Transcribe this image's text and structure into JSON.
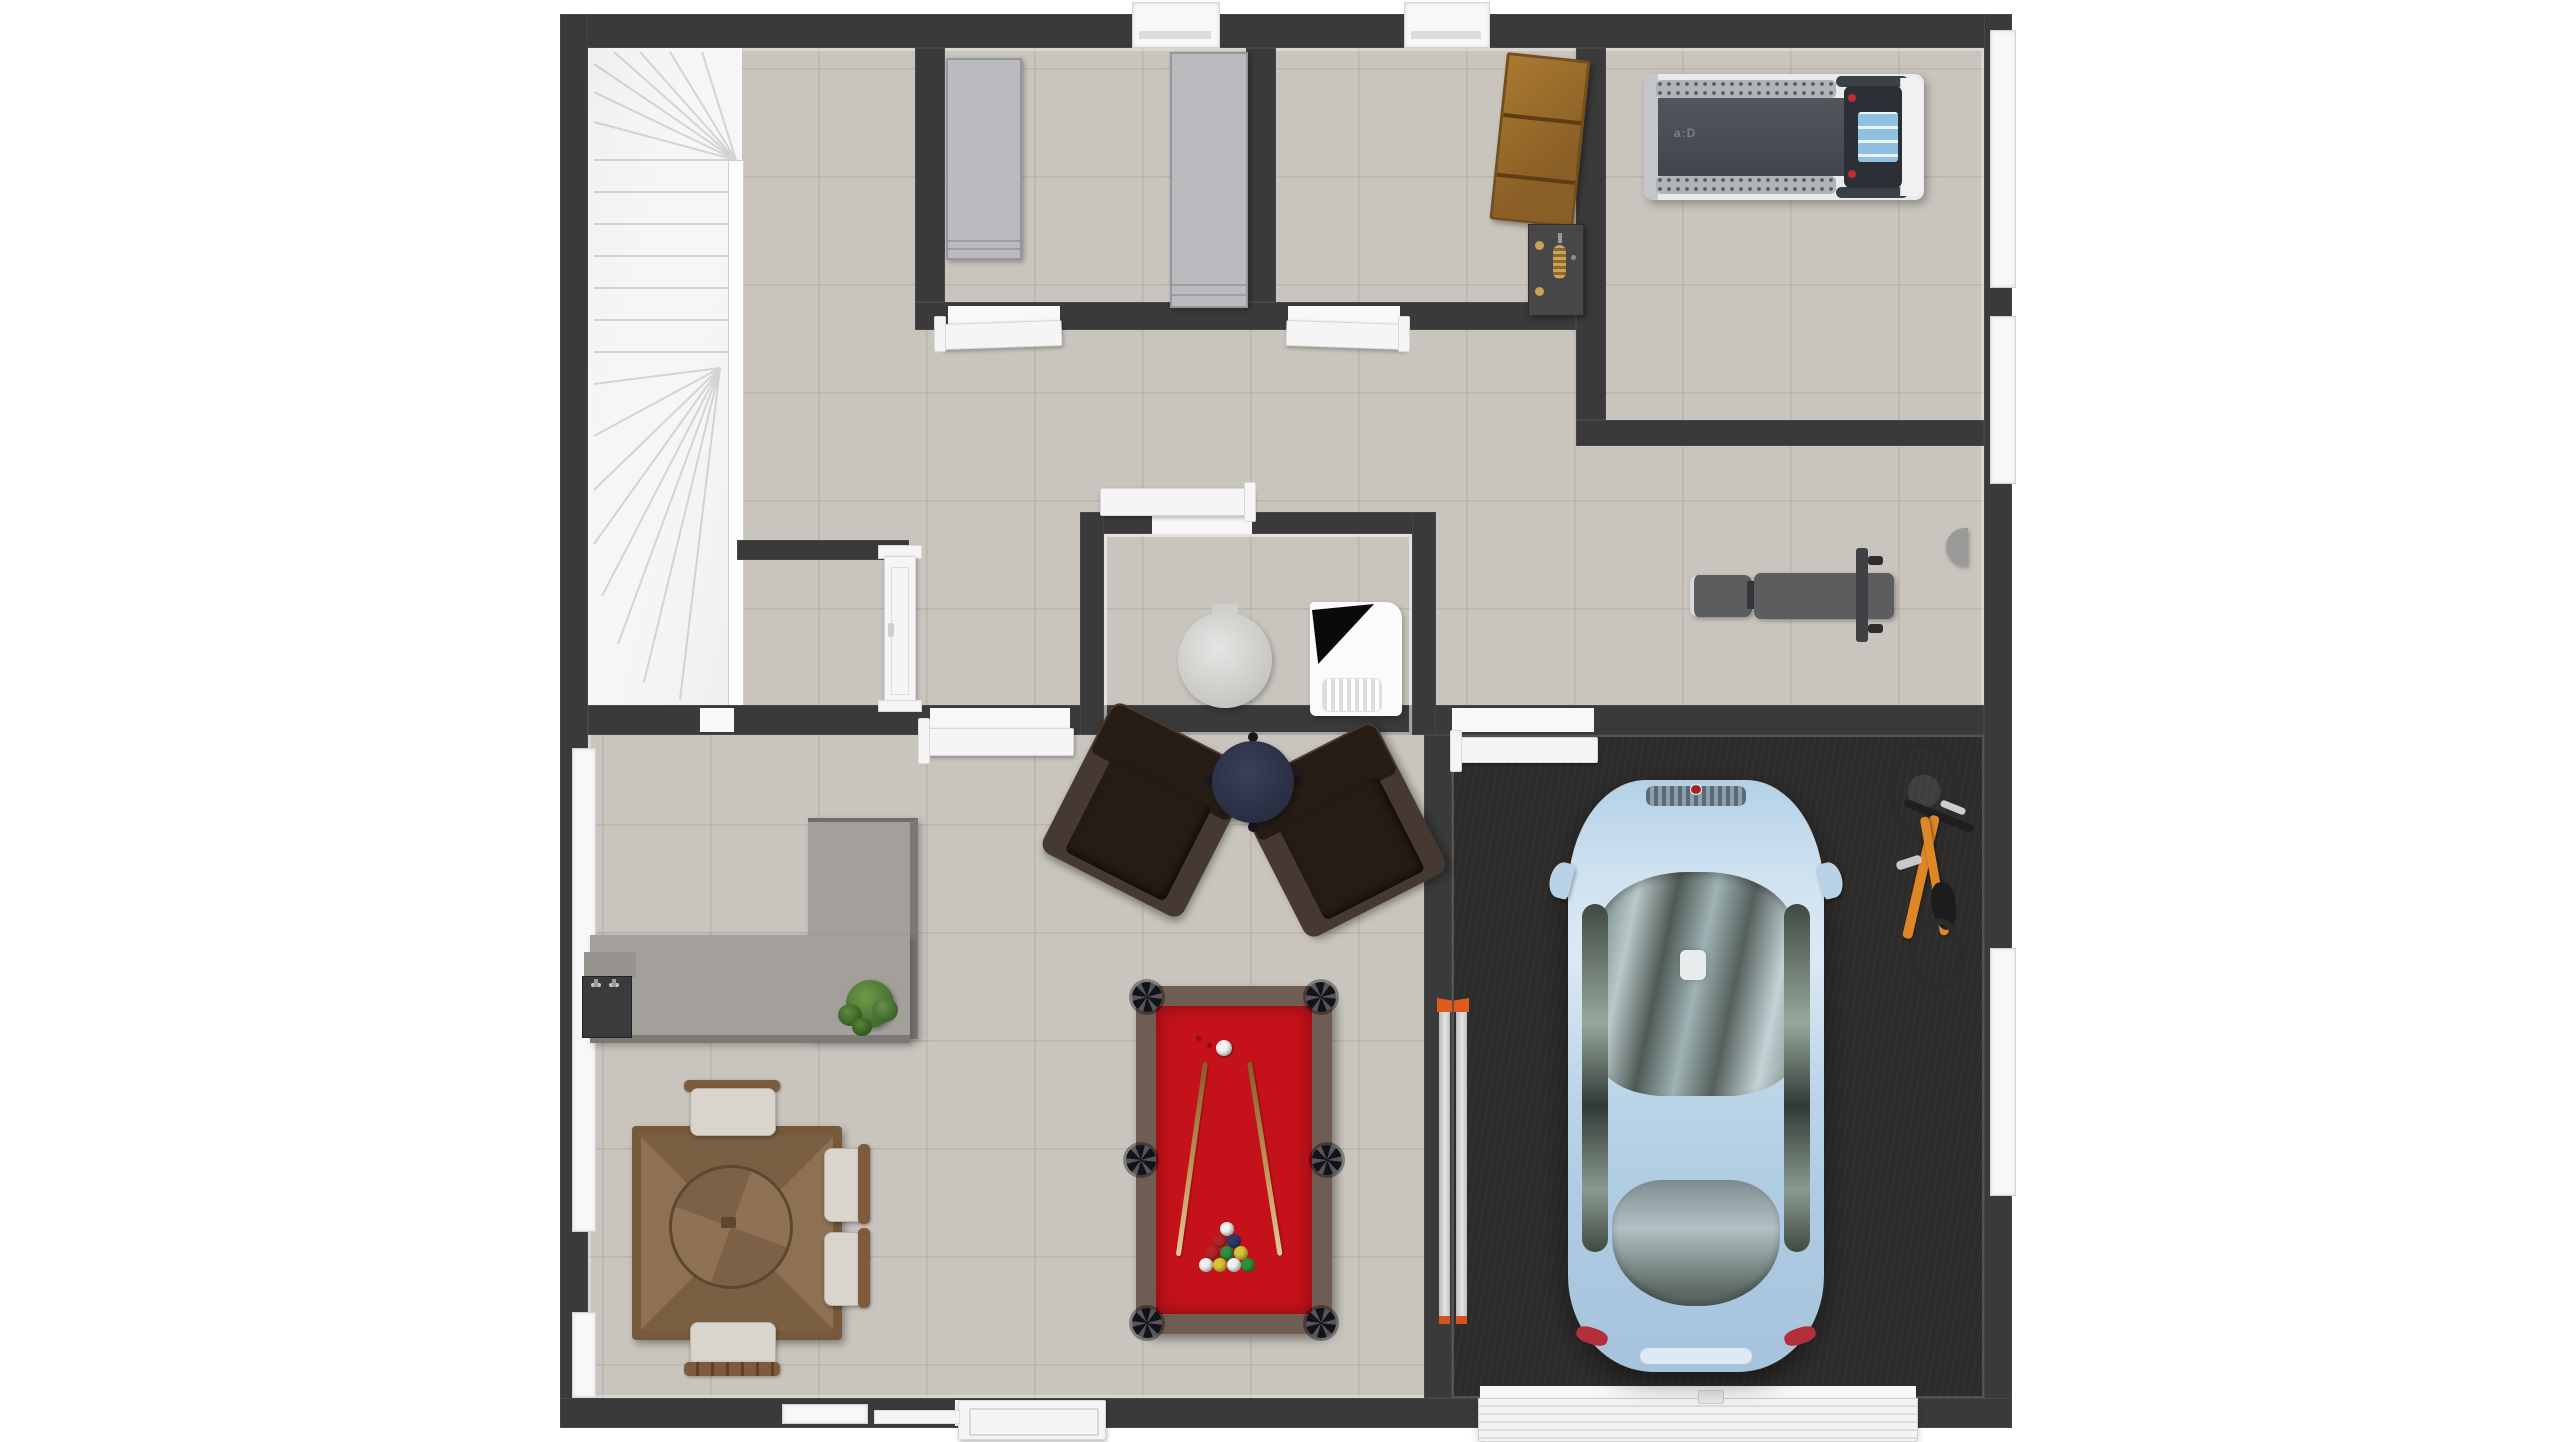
{
  "scene": {
    "type": "3d-floor-plan-top-down-render",
    "visible_text_on_image": "a:D",
    "rooms": [
      {
        "id": "staircase",
        "label": "U-shaped winder staircase"
      },
      {
        "id": "hallway",
        "label": "Hallway"
      },
      {
        "id": "storage-room-a",
        "label": "Storage closet with gray wardrobes"
      },
      {
        "id": "storage-room-b",
        "label": "Storage room with wood shelf and tool rack"
      },
      {
        "id": "gym",
        "label": "Gym room with treadmill"
      },
      {
        "id": "bench-area",
        "label": "Open area with weight bench"
      },
      {
        "id": "powder-room",
        "label": "Powder room with toilet and utility unit"
      },
      {
        "id": "under-stair-closet",
        "label": "Closet under the stairs"
      },
      {
        "id": "rec-room",
        "label": "Recreation room"
      },
      {
        "id": "garage",
        "label": "Garage with dark floor"
      }
    ]
  },
  "objects": {
    "staircase": {
      "label": "U-shaped staircase with winder steps"
    },
    "wardrobe": {
      "label": "Gray wardrobe cabinet"
    },
    "tall_cabinet": {
      "label": "Tall gray storage cabinet"
    },
    "wood_shelf": {
      "label": "Wooden shelf unit"
    },
    "tool_rack": {
      "label": "Dark wall rack with brass knobs"
    },
    "treadmill": {
      "label": "Treadmill with blue console screen",
      "logo": "a:D"
    },
    "weight_bench": {
      "label": "Gray weight bench with bar"
    },
    "toilet": {
      "label": "Round toilet (top view)"
    },
    "utility_unit": {
      "label": "White utility unit with black corner"
    },
    "bar_counter": {
      "label": "L-shaped gray counter"
    },
    "bar_sink": {
      "label": "Dark counter sink with faucets"
    },
    "plant": {
      "label": "Green potted plant"
    },
    "dining_table": {
      "label": "Square parquet wood dining table"
    },
    "dining_chair": {
      "label": "Cream dining chair with wood back"
    },
    "armchair": {
      "label": "Dark brown lounge armchair"
    },
    "side_table": {
      "label": "Navy round side table"
    },
    "pool_table": {
      "label": "Red felt pool table"
    },
    "pool_cue": {
      "label": "Wooden pool cue"
    },
    "cue_ball": {
      "label": "White cue ball"
    },
    "ball_rack": {
      "label": "Racked billiard balls"
    },
    "car": {
      "label": "Light blue hatchback car"
    },
    "bicycle": {
      "label": "Orange bicycle leaning on wall"
    },
    "ladder": {
      "label": "Aluminum ladder with orange tips"
    },
    "garage_door": {
      "label": "White ribbed garage door"
    },
    "entry_door": {
      "label": "White panel entry door"
    },
    "interior_door": {
      "label": "White interior door leaf"
    },
    "window": {
      "label": "Window"
    },
    "wall_fixture": {
      "label": "Gray wall-mounted fixture"
    }
  },
  "palette": {
    "page_bg": "#ffffff",
    "wall": "#3a3a3a",
    "floor_tile": "#c9c5be",
    "garage_floor": "#2d2c2a",
    "stair_tread": "#f6f6f6",
    "stair_edge": "#d4d4d4",
    "door_white": "#f5f5f5",
    "window_white": "#f8f8f8",
    "cabinet_gray": "#b9bbbe",
    "cabinet_edge": "#94969a",
    "wood_shelf": "#9c6e31",
    "wood_shelf_dark": "#6e4a1e",
    "rack_gray": "#47474a",
    "brass": "#c8a153",
    "treadmill_frame": "#e9eaea",
    "treadmill_belt": "#4b4f55",
    "treadmill_rail": "#b0b4b8",
    "console_dark": "#2c3036",
    "screen_blue": "#8fc0e2",
    "button_red": "#c03030",
    "bench_gray": "#5b5d5f",
    "bench_frame": "#3f4144",
    "counter_gray": "#a3a09b",
    "counter_edge": "#7b7974",
    "sink_dark": "#3b3b3d",
    "plant_green": "#4e7b38",
    "table_wood": "#8a6e50",
    "table_wood_dark": "#6b5137",
    "chair_cream": "#d9d5cc",
    "chair_wood": "#7c5c3c",
    "armchair_cushion": "#251c16",
    "armchair_frame": "#453931",
    "side_table_navy": "#2d3246",
    "pool_rail": "#6f5c53",
    "pool_felt": "#c5121a",
    "cue_wood": "#b07b3e",
    "ball_white": "#f2f2f2",
    "ball_red": "#b32428",
    "ball_navy": "#2c3a6b",
    "ball_green": "#2f8f3c",
    "ball_yellow": "#d9c335",
    "car_body": "#aecbe2",
    "car_glass": "#9fb4b7",
    "taillight_red": "#b3303a",
    "bike_orange": "#dd8726",
    "bike_dark": "#2b2b2b",
    "ladder_gray": "#cccccc",
    "ladder_tip": "#e05a1e",
    "toilet_gray": "#d6d6d3",
    "appliance_white": "#fbfbfb"
  }
}
